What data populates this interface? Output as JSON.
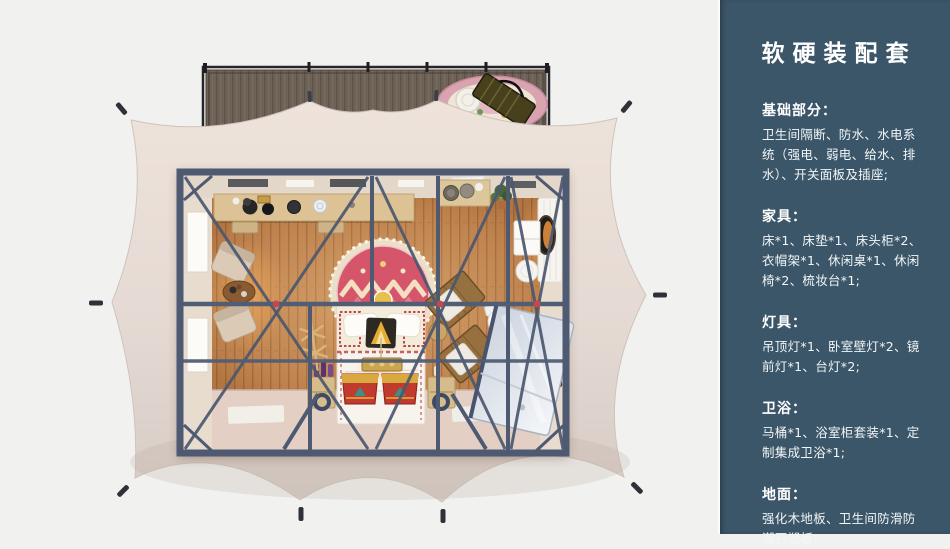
{
  "sidebar": {
    "title": "软硬装配套",
    "sections": [
      {
        "heading": "基础部分：",
        "body": "卫生间隔断、防水、水电系统（强电、弱电、给水、排水）、开关面板及插座;"
      },
      {
        "heading": "家具：",
        "body": "床*1、床垫*1、床头柜*2、衣帽架*1、休闲桌*1、休闲椅*2、梳妆台*1;"
      },
      {
        "heading": "灯具：",
        "body": "吊顶灯*1、卧室壁灯*2、镜前灯*1、台灯*2;"
      },
      {
        "heading": "卫浴：",
        "body": "马桶*1、浴室柜套装*1、定制集成卫浴*1;"
      },
      {
        "heading": "地面：",
        "body": "强化木地板、卫生间防滑防潮石塑板;"
      }
    ]
  },
  "colors": {
    "page_background": "#f1f1f0",
    "sidebar_background": "#3b5668",
    "sidebar_text": "#ffffff",
    "tent_canvas": "#e8ded7",
    "steel_frame": "#4e5a72",
    "wood_floor": "#b97c48",
    "accent_red": "#cf4b57",
    "deck_wood": "#6e6156"
  }
}
